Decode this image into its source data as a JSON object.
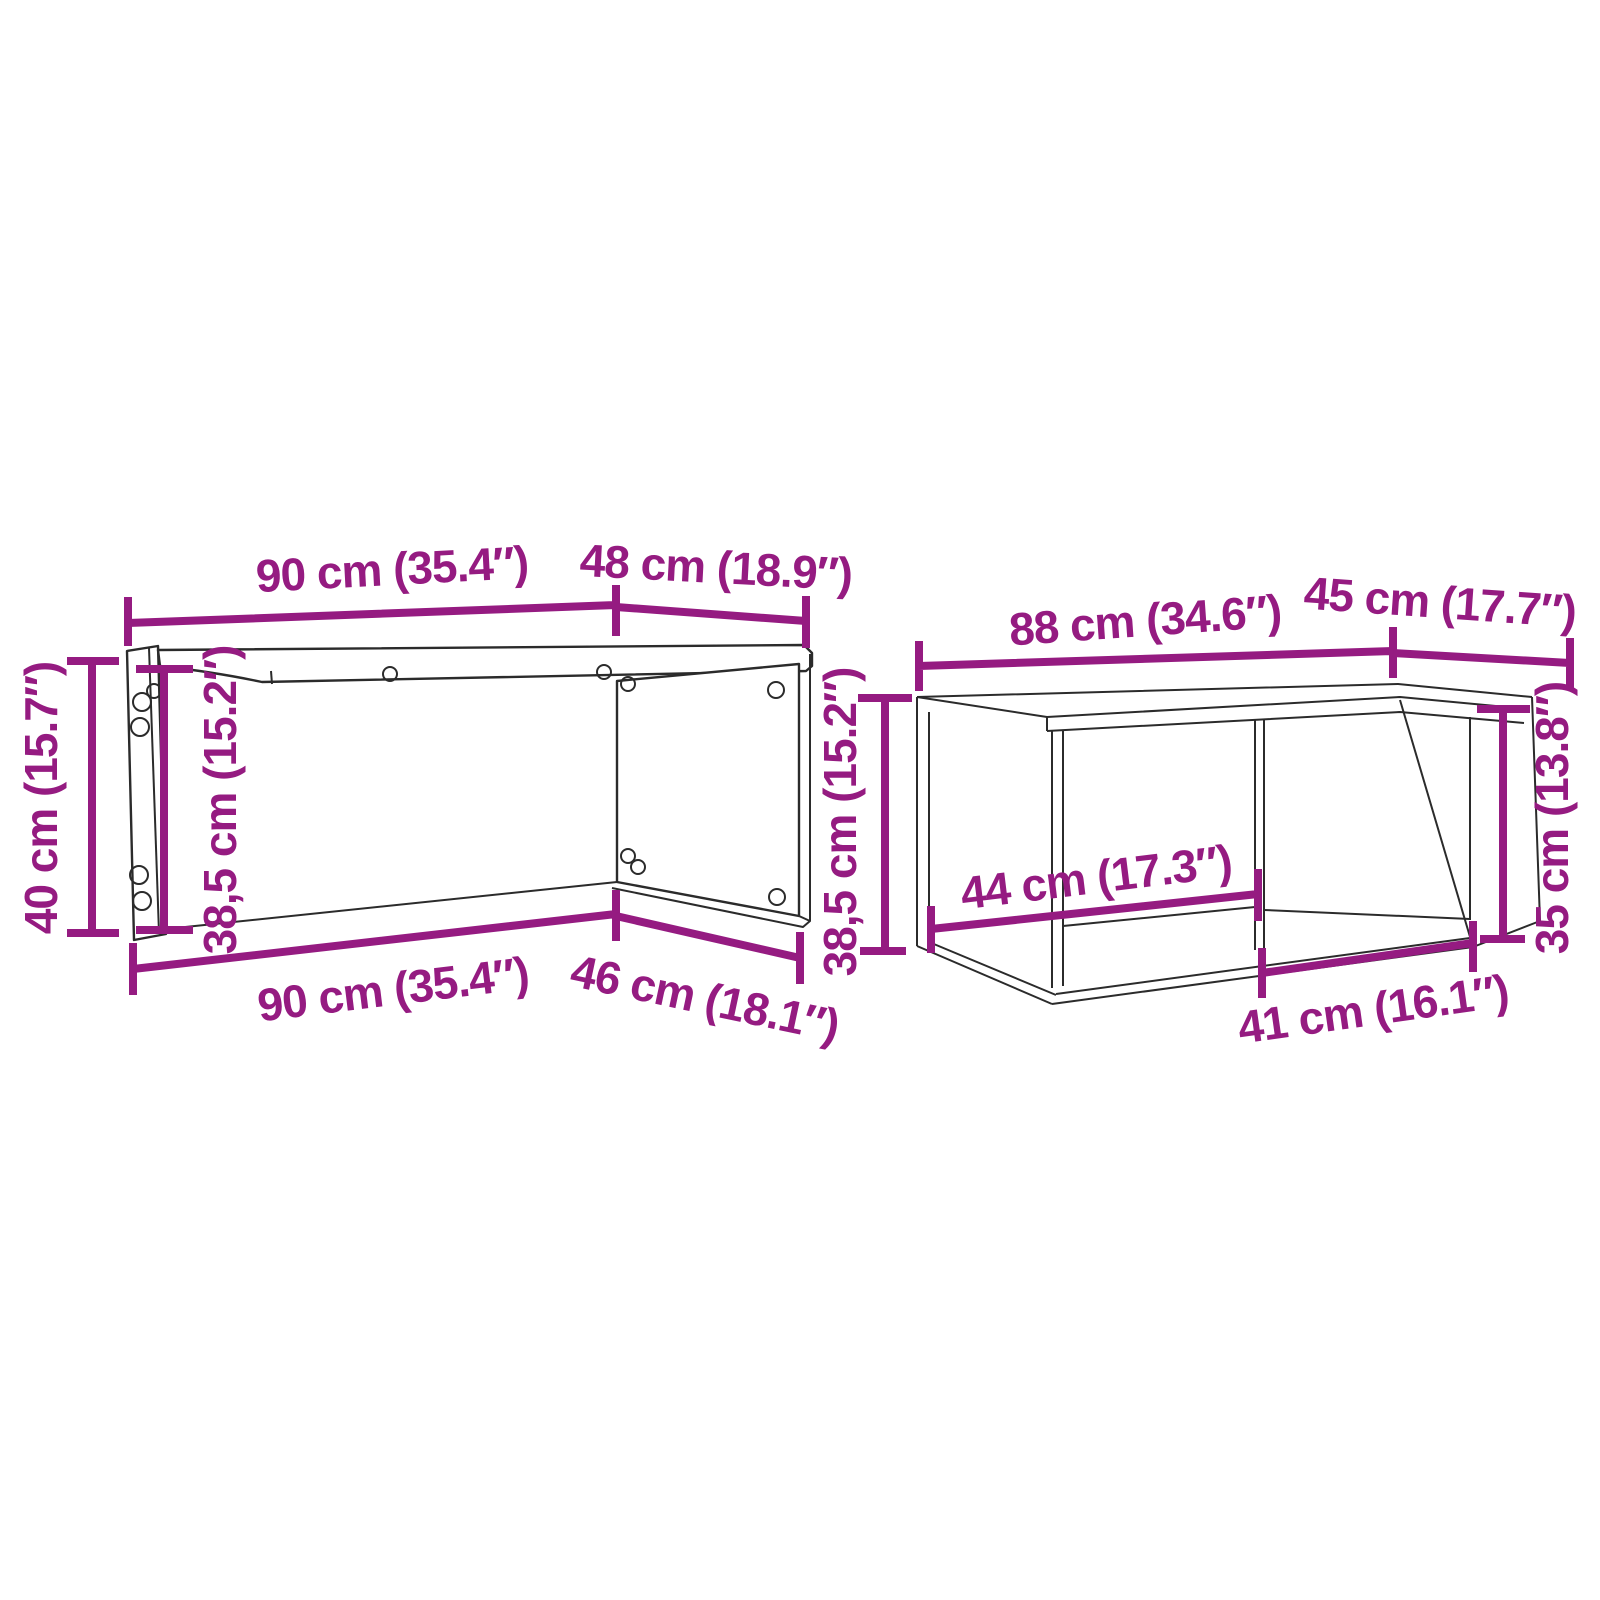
{
  "diagram": {
    "background_color": "#ffffff",
    "outline_color": "#2b2b2b",
    "dimension_color": "#951b81",
    "piece1": {
      "labels": {
        "top_width": "90 cm (35.4″)",
        "top_depth": "48 cm (18.9″)",
        "left_height": "40 cm (15.7″)",
        "left_inner_height": "38,5 cm (15.2″)",
        "bottom_width": "90 cm (35.4″)",
        "bottom_depth": "46 cm (18.1″)",
        "right_inner_height": "38,5 cm (15.2″)"
      }
    },
    "piece2": {
      "labels": {
        "top_width": "88 cm (34.6″)",
        "top_depth": "45 cm (17.7″)",
        "compartment_width": "44 cm (17.3″)",
        "bottom_opening_width": "41 cm (16.1″)",
        "opening_height": "35 cm (13.8″)"
      }
    }
  }
}
